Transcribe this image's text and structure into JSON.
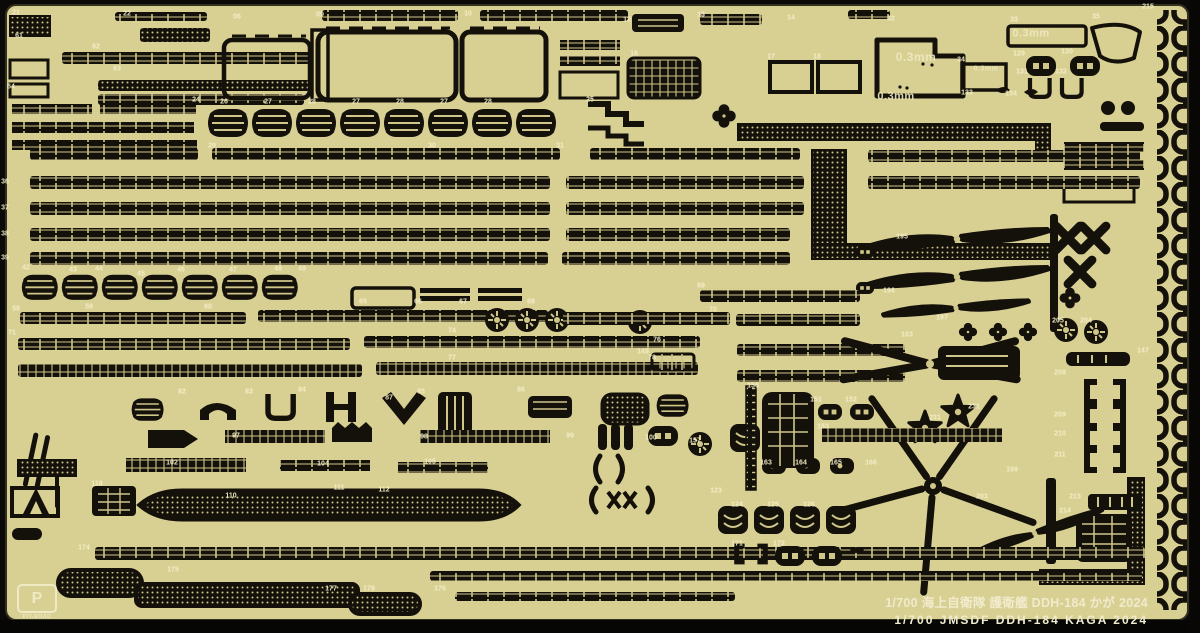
{
  "captions": {
    "line1_jp": "1/700  海上自衛隊 護衛艦 DDH-184 かが 2024",
    "line2_en": "1/700  JMSDF DDH-184   KAGA   2024"
  },
  "brand": {
    "monogram": "P",
    "name": "PIT-ROAD"
  },
  "material": {
    "thickness": "0.3mm"
  },
  "colors": {
    "sheet": "#d8d093",
    "etched_part": "#14100a",
    "etch_relief": "#cfc689",
    "label_text": "#f4efc8",
    "background": "#0b0a08"
  },
  "thickness_labels": [
    {
      "t": "0.3mm",
      "x": 916,
      "y": 57,
      "s": 12
    },
    {
      "t": "0.3mm",
      "x": 896,
      "y": 97,
      "s": 11
    },
    {
      "t": "0.3mm",
      "x": 1031,
      "y": 34,
      "s": 11
    },
    {
      "t": "0.3mm",
      "x": 986,
      "y": 69,
      "s": 7
    }
  ],
  "part_labels": [
    {
      "t": "21",
      "x": 16,
      "y": 13
    },
    {
      "t": "22",
      "x": 127,
      "y": 14
    },
    {
      "t": "06",
      "x": 237,
      "y": 17
    },
    {
      "t": "09",
      "x": 320,
      "y": 15
    },
    {
      "t": "10",
      "x": 468,
      "y": 14
    },
    {
      "t": "12",
      "x": 627,
      "y": 20
    },
    {
      "t": "13",
      "x": 701,
      "y": 15
    },
    {
      "t": "14",
      "x": 791,
      "y": 18
    },
    {
      "t": "32",
      "x": 891,
      "y": 19
    },
    {
      "t": "33",
      "x": 1014,
      "y": 20
    },
    {
      "t": "35",
      "x": 1096,
      "y": 17
    },
    {
      "t": "215",
      "x": 1148,
      "y": 7
    },
    {
      "t": "61",
      "x": 19,
      "y": 36
    },
    {
      "t": "62",
      "x": 96,
      "y": 47
    },
    {
      "t": "63",
      "x": 117,
      "y": 69
    },
    {
      "t": "64",
      "x": 11,
      "y": 87
    },
    {
      "t": "16",
      "x": 634,
      "y": 54
    },
    {
      "t": "17",
      "x": 771,
      "y": 57
    },
    {
      "t": "18",
      "x": 817,
      "y": 57
    },
    {
      "t": "34",
      "x": 961,
      "y": 60
    },
    {
      "t": "129",
      "x": 1019,
      "y": 54
    },
    {
      "t": "130",
      "x": 1067,
      "y": 52
    },
    {
      "t": "131",
      "x": 1022,
      "y": 72
    },
    {
      "t": "132",
      "x": 1061,
      "y": 72
    },
    {
      "t": "133",
      "x": 967,
      "y": 93
    },
    {
      "t": "134",
      "x": 1011,
      "y": 94
    },
    {
      "t": "24",
      "x": 196,
      "y": 100
    },
    {
      "t": "26",
      "x": 224,
      "y": 102
    },
    {
      "t": "27",
      "x": 268,
      "y": 102
    },
    {
      "t": "28",
      "x": 312,
      "y": 102
    },
    {
      "t": "27",
      "x": 356,
      "y": 102
    },
    {
      "t": "28",
      "x": 400,
      "y": 102
    },
    {
      "t": "27",
      "x": 444,
      "y": 102
    },
    {
      "t": "28",
      "x": 488,
      "y": 102
    },
    {
      "t": "25",
      "x": 590,
      "y": 100
    },
    {
      "t": "29",
      "x": 212,
      "y": 146
    },
    {
      "t": "30",
      "x": 432,
      "y": 146
    },
    {
      "t": "31",
      "x": 560,
      "y": 146
    },
    {
      "t": "36",
      "x": 5,
      "y": 182
    },
    {
      "t": "37",
      "x": 5,
      "y": 208
    },
    {
      "t": "38",
      "x": 5,
      "y": 234
    },
    {
      "t": "39",
      "x": 5,
      "y": 258
    },
    {
      "t": "195",
      "x": 902,
      "y": 237
    },
    {
      "t": "196",
      "x": 889,
      "y": 291
    },
    {
      "t": "197",
      "x": 942,
      "y": 318
    },
    {
      "t": "204",
      "x": 1086,
      "y": 321
    },
    {
      "t": "205",
      "x": 1058,
      "y": 321
    },
    {
      "t": "42",
      "x": 26,
      "y": 268
    },
    {
      "t": "43",
      "x": 73,
      "y": 270
    },
    {
      "t": "44",
      "x": 99,
      "y": 269
    },
    {
      "t": "45",
      "x": 141,
      "y": 274
    },
    {
      "t": "46",
      "x": 181,
      "y": 270
    },
    {
      "t": "47",
      "x": 233,
      "y": 270
    },
    {
      "t": "48",
      "x": 278,
      "y": 269
    },
    {
      "t": "49",
      "x": 302,
      "y": 269
    },
    {
      "t": "58",
      "x": 16,
      "y": 309
    },
    {
      "t": "59",
      "x": 89,
      "y": 307
    },
    {
      "t": "60",
      "x": 208,
      "y": 307
    },
    {
      "t": "65",
      "x": 363,
      "y": 302
    },
    {
      "t": "66",
      "x": 418,
      "y": 302
    },
    {
      "t": "67",
      "x": 463,
      "y": 302
    },
    {
      "t": "68",
      "x": 531,
      "y": 302
    },
    {
      "t": "69",
      "x": 701,
      "y": 286
    },
    {
      "t": "70",
      "x": 713,
      "y": 310
    },
    {
      "t": "71",
      "x": 12,
      "y": 333
    },
    {
      "t": "74",
      "x": 452,
      "y": 331
    },
    {
      "t": "76",
      "x": 657,
      "y": 340
    },
    {
      "t": "77",
      "x": 452,
      "y": 358
    },
    {
      "t": "78",
      "x": 652,
      "y": 358
    },
    {
      "t": "147",
      "x": 1143,
      "y": 351
    },
    {
      "t": "149",
      "x": 643,
      "y": 352
    },
    {
      "t": "103",
      "x": 907,
      "y": 335
    },
    {
      "t": "199",
      "x": 1012,
      "y": 470
    },
    {
      "t": "203",
      "x": 982,
      "y": 497
    },
    {
      "t": "231",
      "x": 935,
      "y": 418
    },
    {
      "t": "231",
      "x": 974,
      "y": 407
    },
    {
      "t": "208",
      "x": 1060,
      "y": 373
    },
    {
      "t": "209",
      "x": 1060,
      "y": 415
    },
    {
      "t": "210",
      "x": 1060,
      "y": 434
    },
    {
      "t": "211",
      "x": 1060,
      "y": 455
    },
    {
      "t": "213",
      "x": 1075,
      "y": 497
    },
    {
      "t": "214",
      "x": 1065,
      "y": 511
    },
    {
      "t": "82",
      "x": 182,
      "y": 392
    },
    {
      "t": "83",
      "x": 249,
      "y": 392
    },
    {
      "t": "84",
      "x": 302,
      "y": 390
    },
    {
      "t": "85",
      "x": 421,
      "y": 392
    },
    {
      "t": "86",
      "x": 521,
      "y": 390
    },
    {
      "t": "87",
      "x": 389,
      "y": 398
    },
    {
      "t": "97",
      "x": 236,
      "y": 436
    },
    {
      "t": "98",
      "x": 424,
      "y": 437
    },
    {
      "t": "99",
      "x": 570,
      "y": 436
    },
    {
      "t": "100",
      "x": 651,
      "y": 438
    },
    {
      "t": "102",
      "x": 172,
      "y": 463
    },
    {
      "t": "104",
      "x": 323,
      "y": 464
    },
    {
      "t": "105",
      "x": 430,
      "y": 462
    },
    {
      "t": "110",
      "x": 231,
      "y": 496
    },
    {
      "t": "111",
      "x": 339,
      "y": 488
    },
    {
      "t": "112",
      "x": 384,
      "y": 490
    },
    {
      "t": "118",
      "x": 97,
      "y": 484
    },
    {
      "t": "151",
      "x": 816,
      "y": 400
    },
    {
      "t": "152",
      "x": 851,
      "y": 400
    },
    {
      "t": "153",
      "x": 823,
      "y": 427
    },
    {
      "t": "156",
      "x": 753,
      "y": 386
    },
    {
      "t": "157",
      "x": 695,
      "y": 441
    },
    {
      "t": "163",
      "x": 766,
      "y": 463
    },
    {
      "t": "164",
      "x": 801,
      "y": 463
    },
    {
      "t": "165",
      "x": 836,
      "y": 463
    },
    {
      "t": "166",
      "x": 871,
      "y": 463
    },
    {
      "t": "123",
      "x": 716,
      "y": 491
    },
    {
      "t": "124",
      "x": 737,
      "y": 505
    },
    {
      "t": "125",
      "x": 773,
      "y": 505
    },
    {
      "t": "126",
      "x": 809,
      "y": 505
    },
    {
      "t": "174",
      "x": 84,
      "y": 548
    },
    {
      "t": "175",
      "x": 173,
      "y": 570
    },
    {
      "t": "176",
      "x": 440,
      "y": 589
    },
    {
      "t": "177",
      "x": 331,
      "y": 589
    },
    {
      "t": "178",
      "x": 369,
      "y": 589
    },
    {
      "t": "171",
      "x": 737,
      "y": 544
    },
    {
      "t": "172",
      "x": 779,
      "y": 544
    }
  ]
}
